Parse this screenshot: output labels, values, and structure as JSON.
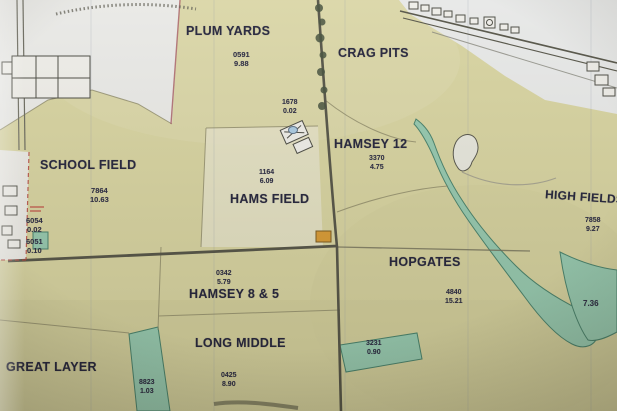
{
  "map": {
    "description": "Photograph of a farm parcel map with field names, parcel numbers and acreages",
    "fields": {
      "plum_yards": {
        "name": "PLUM YARDS",
        "parcel": "0591",
        "area": "9.88"
      },
      "crag_pits": {
        "name": "CRAG PITS"
      },
      "hamsey_12": {
        "name": "HAMSEY 12",
        "parcel": "3370",
        "area": "4.75"
      },
      "school_field": {
        "name": "SCHOOL FIELD",
        "parcel": "7864",
        "area": "10.63"
      },
      "hams_field": {
        "name": "HAMS FIELD",
        "parcel": "1164",
        "area": "6.09"
      },
      "high_fields": {
        "name": "HIGH FIELDS",
        "parcel": "7858",
        "area": "9.27"
      },
      "hopgates": {
        "name": "HOPGATES",
        "parcel": "4840",
        "area": "15.21"
      },
      "hamsey_8_5": {
        "name": "HAMSEY 8 & 5",
        "parcel": "0342",
        "area": "5.79"
      },
      "long_middle": {
        "name": "LONG MIDDLE",
        "parcel": "0425",
        "area": "8.90"
      },
      "great_layer": {
        "name": "GREAT LAYER"
      }
    },
    "small_parcels": {
      "p1678": {
        "parcel": "1678",
        "area": "0.02"
      },
      "p6054": {
        "parcel": "6054",
        "area": "0.02"
      },
      "p6051": {
        "parcel": "6051",
        "area": "0.10"
      },
      "p3231": {
        "parcel": "3231",
        "area": "0.90"
      },
      "p8823": {
        "parcel": "8823",
        "area": "1.03"
      },
      "p736": {
        "area": "7.36"
      }
    },
    "colors": {
      "field_fill": "#d7d3a0",
      "woodland_fill": "#95c8ae",
      "paper": "#e9e8e2",
      "ink": "#23233a",
      "road": "#545346",
      "boundary_red": "#b4443c",
      "building_orange": "#d89a33"
    }
  }
}
